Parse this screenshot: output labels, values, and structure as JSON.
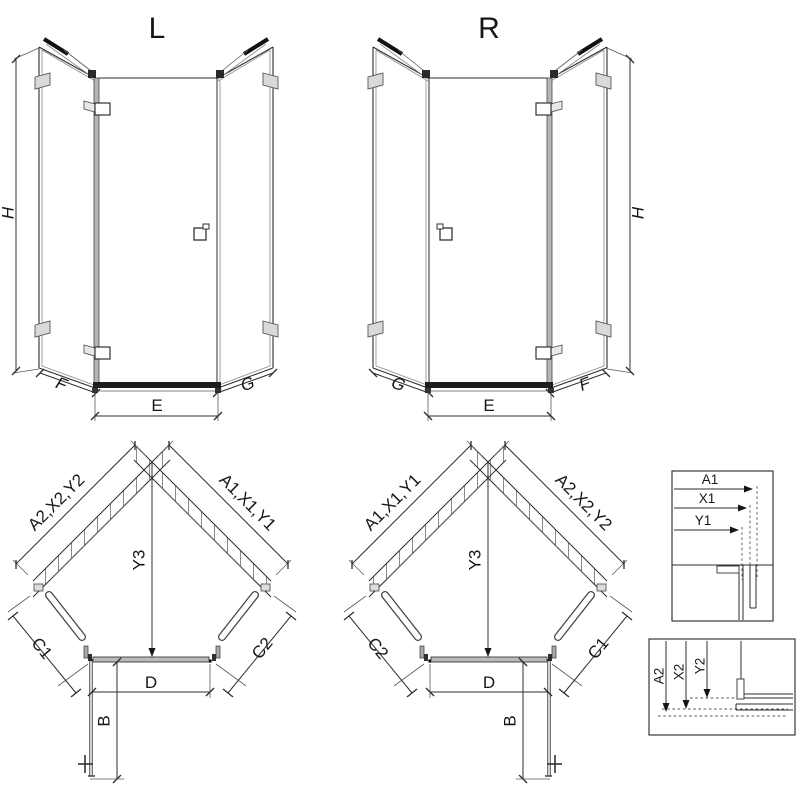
{
  "elevation_left": {
    "title": "L",
    "dim_height": "H",
    "dim_left": "F",
    "dim_door": "E",
    "dim_right": "G"
  },
  "elevation_right": {
    "title": "R",
    "dim_height": "H",
    "dim_left": "G",
    "dim_door": "E",
    "dim_right": "F"
  },
  "plan_left": {
    "wall_left": "A2,X2,Y2",
    "wall_right": "A1,X1,Y1",
    "depth": "Y3",
    "side_left": "C1",
    "side_right": "C2",
    "front": "D",
    "swing": "B"
  },
  "plan_right": {
    "wall_left": "A1,X1,Y1",
    "wall_right": "A2,X2,Y2",
    "depth": "Y3",
    "side_left": "C2",
    "side_right": "C1",
    "front": "D",
    "swing": "B"
  },
  "detail_top": {
    "dims": [
      "A1",
      "X1",
      "Y1"
    ]
  },
  "detail_bottom": {
    "dims": [
      "A2",
      "X2",
      "Y2"
    ]
  },
  "colors": {
    "line": "#2e2e2e",
    "mid_gray": "#8a8a8a",
    "light_gray": "#d9d9d9",
    "dark": "#161616",
    "background": "#ffffff"
  }
}
